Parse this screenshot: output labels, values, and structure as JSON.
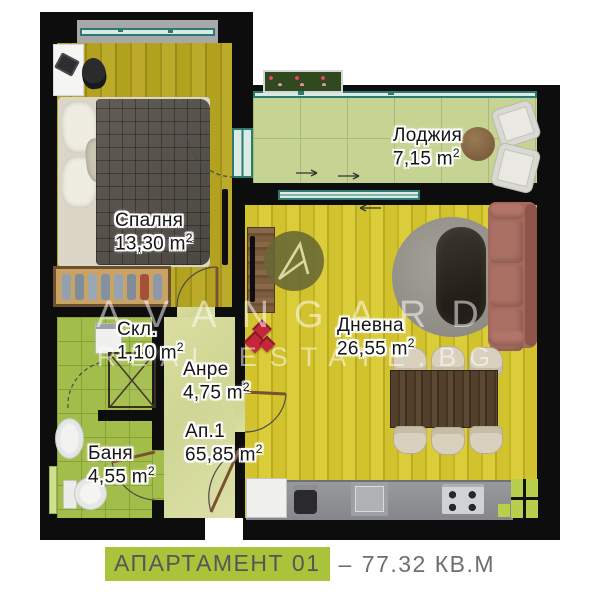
{
  "caption": {
    "apartment": "АПАРТАМЕНТ 01",
    "dash": "–",
    "area": "77.32 КВ.М"
  },
  "watermark": {
    "brand": "AVANGARD",
    "domain": "REAL ESTATE.BG",
    "logo": "avangard-a-logo"
  },
  "sup": "2",
  "rooms": {
    "bedroom": {
      "name": "Спалня",
      "area": "13,30 m"
    },
    "loggia": {
      "name": "Лоджия",
      "area": "7,15 m"
    },
    "living": {
      "name": "Дневна",
      "area": "26,55 m"
    },
    "storage": {
      "name": "Скл.",
      "area": "1,10 m"
    },
    "hall": {
      "name": "Анре",
      "area": "4,75 m"
    },
    "unit": {
      "name": "Ап.1",
      "area": "65,85 m"
    },
    "bath": {
      "name": "Баня",
      "area": "4,55 m"
    }
  },
  "colors": {
    "caption_highlight": "#a9c43a",
    "caption_text": "#55565a",
    "wall": "#0d0d0d",
    "window_frame": "#2d7a74",
    "bedroom_floor": "#b3a220",
    "living_floor": "#d2c32e",
    "loggia_tiles": "#c5d492",
    "bath_tiles": "#a3bd4b",
    "sofa": "#a5695c"
  }
}
